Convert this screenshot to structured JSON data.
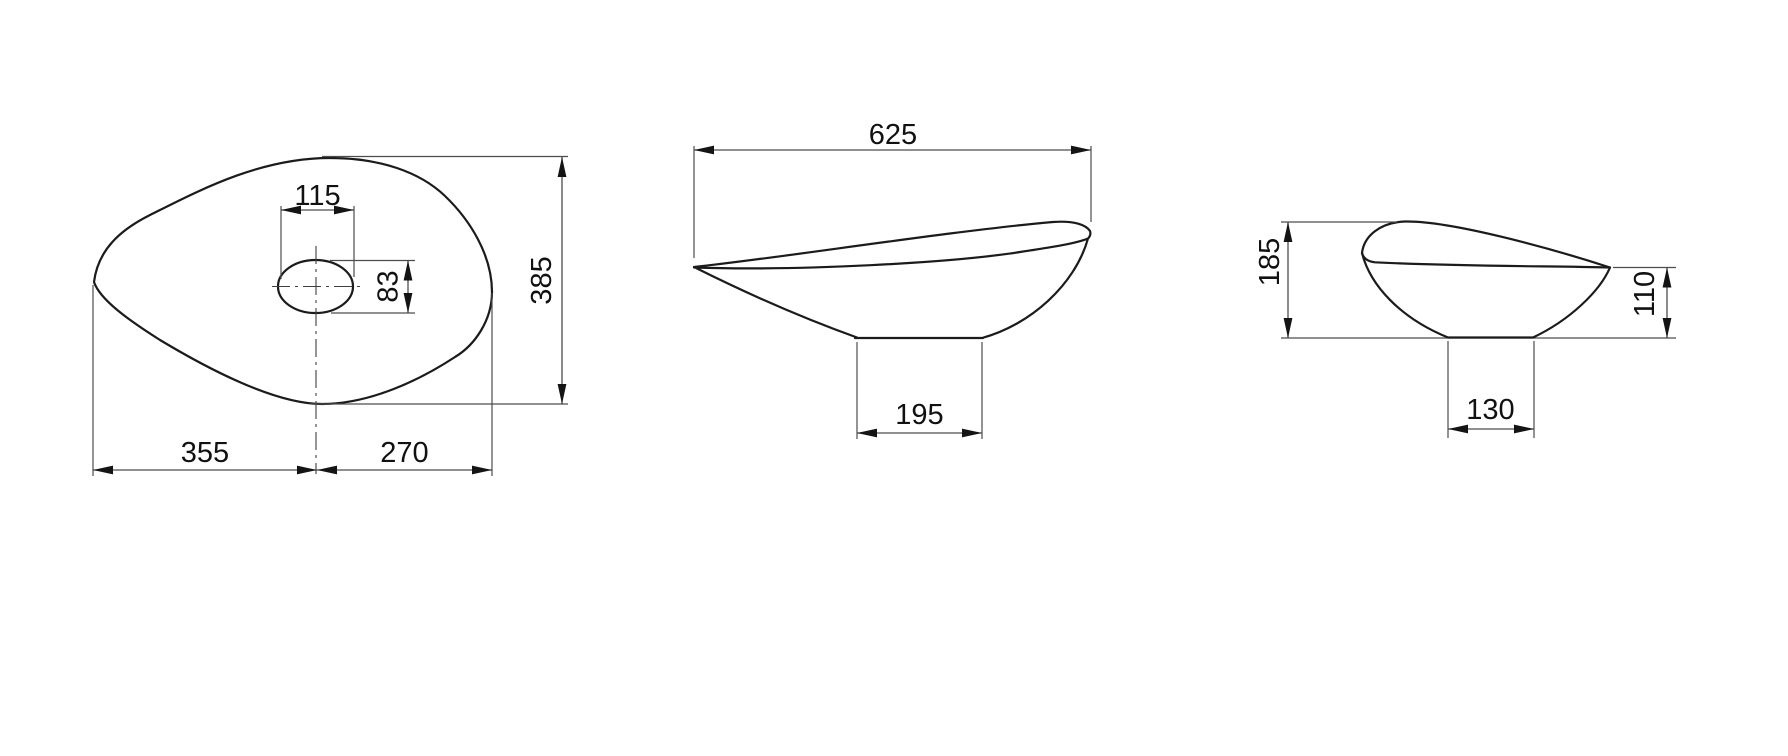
{
  "drawing": {
    "views": {
      "top": {
        "dims": {
          "hole_width": "115",
          "hole_height": "83",
          "overall_depth": "385",
          "left_to_drain_center": "355",
          "drain_center_to_right": "270"
        }
      },
      "front": {
        "dims": {
          "overall_width": "625",
          "base_width": "195"
        }
      },
      "side": {
        "dims": {
          "overall_height": "185",
          "rim_tip_height": "110",
          "base_depth": "130"
        }
      }
    },
    "colors": {
      "outline": "#1b1b1b",
      "dimension_lines": "#4d4d4d",
      "text": "#111111",
      "background": "#ffffff"
    }
  }
}
